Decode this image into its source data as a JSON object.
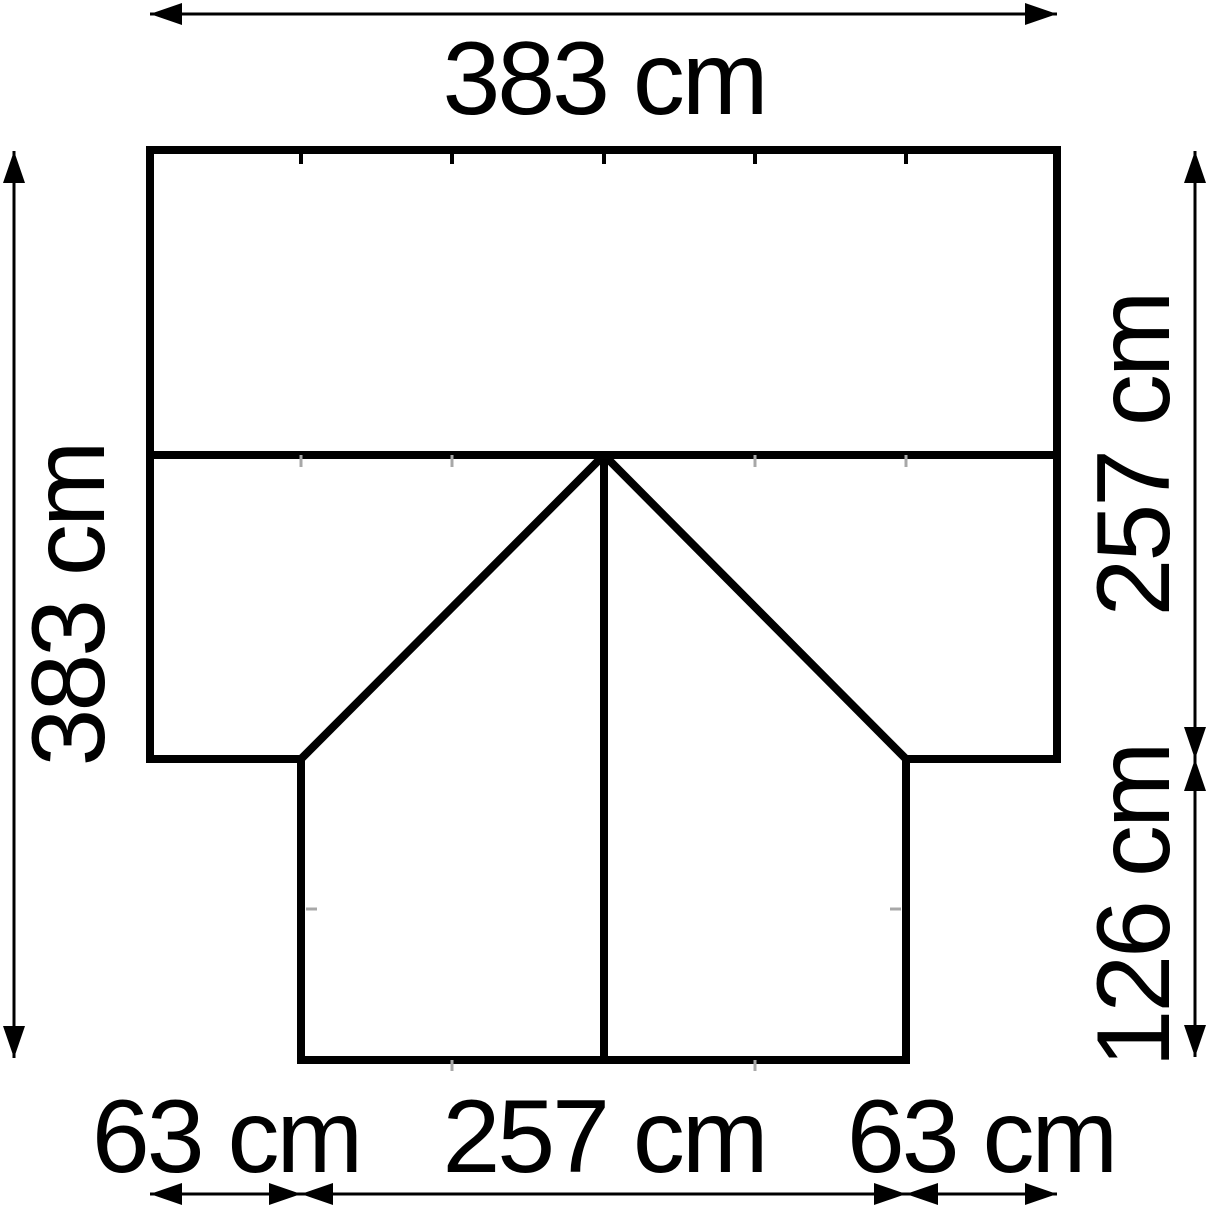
{
  "diagram": {
    "kind": "dimension-drawing-floor-plan",
    "unit": "cm",
    "colors": {
      "line": "#000000",
      "background": "#ffffff",
      "faint_tick": "#a8a8a8"
    },
    "dimensions": {
      "top_width": {
        "label": "383 cm",
        "value": 383
      },
      "left_height": {
        "label": "383 cm",
        "value": 383
      },
      "right_upper_depth": {
        "label": "257 cm",
        "value": 257
      },
      "right_lower_depth": {
        "label": "126 cm",
        "value": 126
      },
      "bottom_left_segment": {
        "label": "63 cm",
        "value": 63
      },
      "bottom_center_segment": {
        "label": "257 cm",
        "value": 257
      },
      "bottom_right_segment": {
        "label": "63 cm",
        "value": 63
      }
    }
  }
}
